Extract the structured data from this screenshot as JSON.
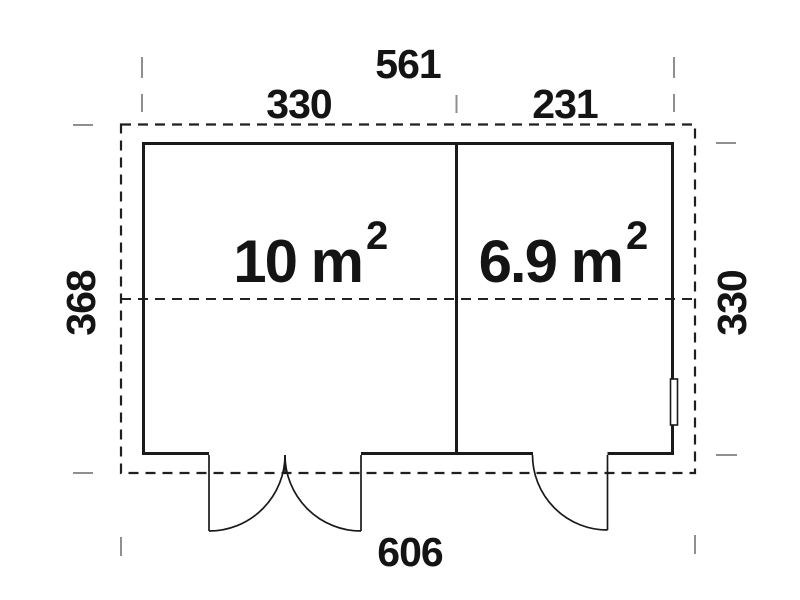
{
  "dimensions": {
    "top_overall": "561",
    "top_left_section": "330",
    "top_right_section": "231",
    "left_height": "368",
    "right_height": "330",
    "bottom_overall": "606"
  },
  "rooms": [
    {
      "label_main": "10 m",
      "label_sup": "2"
    },
    {
      "label_main": "6.9 m",
      "label_sup": "2"
    }
  ],
  "colors": {
    "line": "#1a1a1a",
    "extension_gray": "#8f8f8f",
    "background": "#ffffff",
    "text": "#141414"
  }
}
